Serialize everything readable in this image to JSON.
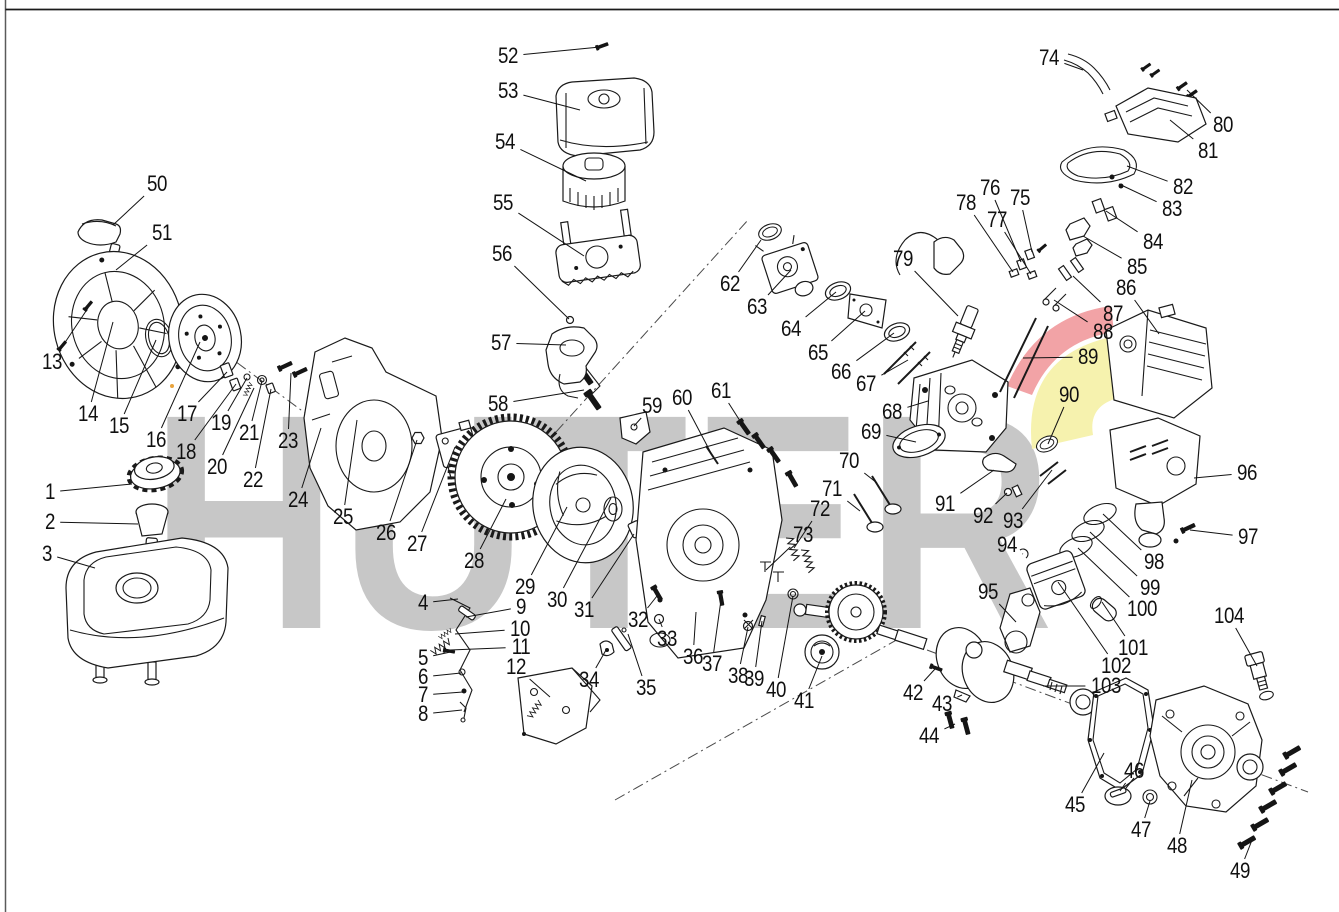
{
  "brand": {
    "watermark_text": "HUTER",
    "watermark_color": "#c7c7c7",
    "swoosh_red": "#f2a3a6",
    "swoosh_yellow": "#f6f2ae",
    "line_color": "#1a1a1a"
  },
  "callouts": [
    {
      "n": "1",
      "x": 50,
      "y": 492,
      "tx": 132,
      "ty": 484
    },
    {
      "n": "2",
      "x": 50,
      "y": 522,
      "tx": 138,
      "ty": 524
    },
    {
      "n": "3",
      "x": 47,
      "y": 554,
      "tx": 95,
      "ty": 568
    },
    {
      "n": "4",
      "x": 423,
      "y": 603,
      "tx": 458,
      "ty": 599
    },
    {
      "n": "5",
      "x": 423,
      "y": 658,
      "tx": 455,
      "ty": 651
    },
    {
      "n": "6",
      "x": 423,
      "y": 677,
      "tx": 461,
      "ty": 673
    },
    {
      "n": "7",
      "x": 423,
      "y": 695,
      "tx": 463,
      "ty": 692
    },
    {
      "n": "8",
      "x": 423,
      "y": 714,
      "tx": 462,
      "ty": 710
    },
    {
      "n": "9",
      "x": 521,
      "y": 607,
      "tx": 466,
      "ty": 617
    },
    {
      "n": "10",
      "x": 520,
      "y": 629,
      "tx": 455,
      "ty": 634
    },
    {
      "n": "11",
      "x": 521,
      "y": 647,
      "tx": 450,
      "ty": 650
    },
    {
      "n": "12",
      "x": 516,
      "y": 667,
      "tx": 550,
      "ty": 697
    },
    {
      "n": "13",
      "x": 52,
      "y": 362,
      "tx": 88,
      "ty": 308
    },
    {
      "n": "14",
      "x": 88,
      "y": 414,
      "tx": 113,
      "ty": 322
    },
    {
      "n": "15",
      "x": 119,
      "y": 426,
      "tx": 156,
      "ty": 340
    },
    {
      "n": "16",
      "x": 156,
      "y": 440,
      "tx": 200,
      "ty": 342
    },
    {
      "n": "17",
      "x": 187,
      "y": 414,
      "tx": 227,
      "ty": 372
    },
    {
      "n": "18",
      "x": 186,
      "y": 452,
      "tx": 236,
      "ty": 384
    },
    {
      "n": "19",
      "x": 221,
      "y": 423,
      "tx": 247,
      "ty": 378
    },
    {
      "n": "20",
      "x": 217,
      "y": 467,
      "tx": 254,
      "ty": 388
    },
    {
      "n": "21",
      "x": 249,
      "y": 433,
      "tx": 262,
      "ty": 381
    },
    {
      "n": "22",
      "x": 253,
      "y": 480,
      "tx": 271,
      "ty": 389
    },
    {
      "n": "23",
      "x": 288,
      "y": 441,
      "tx": 291,
      "ty": 373
    },
    {
      "n": "24",
      "x": 298,
      "y": 500,
      "tx": 321,
      "ty": 428
    },
    {
      "n": "25",
      "x": 343,
      "y": 517,
      "tx": 357,
      "ty": 420
    },
    {
      "n": "26",
      "x": 386,
      "y": 533,
      "tx": 417,
      "ty": 440
    },
    {
      "n": "27",
      "x": 417,
      "y": 544,
      "tx": 455,
      "ty": 447
    },
    {
      "n": "28",
      "x": 474,
      "y": 561,
      "tx": 506,
      "ty": 499
    },
    {
      "n": "29",
      "x": 525,
      "y": 587,
      "tx": 567,
      "ty": 507
    },
    {
      "n": "30",
      "x": 557,
      "y": 600,
      "tx": 611,
      "ty": 498
    },
    {
      "n": "31",
      "x": 584,
      "y": 610,
      "tx": 634,
      "ty": 534
    },
    {
      "n": "32",
      "x": 638,
      "y": 620,
      "tx": 657,
      "ty": 596
    },
    {
      "n": "33",
      "x": 667,
      "y": 639,
      "tx": 659,
      "ty": 619
    },
    {
      "n": "34",
      "x": 589,
      "y": 680,
      "tx": 606,
      "ty": 650
    },
    {
      "n": "35",
      "x": 646,
      "y": 688,
      "tx": 628,
      "ty": 634
    },
    {
      "n": "36",
      "x": 693,
      "y": 657,
      "tx": 696,
      "ty": 612
    },
    {
      "n": "37",
      "x": 712,
      "y": 664,
      "tx": 721,
      "ty": 600
    },
    {
      "n": "38",
      "x": 738,
      "y": 676,
      "tx": 748,
      "ty": 627
    },
    {
      "n": "39",
      "x": 754,
      "y": 679,
      "tx": 762,
      "ty": 621
    },
    {
      "n": "40",
      "x": 776,
      "y": 690,
      "tx": 793,
      "ty": 596
    },
    {
      "n": "41",
      "x": 804,
      "y": 701,
      "tx": 822,
      "ty": 656
    },
    {
      "n": "42",
      "x": 913,
      "y": 693,
      "tx": 935,
      "ty": 669
    },
    {
      "n": "43",
      "x": 942,
      "y": 704,
      "tx": 962,
      "ty": 695
    },
    {
      "n": "44",
      "x": 929,
      "y": 736,
      "tx": 955,
      "ty": 724
    },
    {
      "n": "45",
      "x": 1075,
      "y": 805,
      "tx": 1104,
      "ty": 753
    },
    {
      "n": "46",
      "x": 1134,
      "y": 771,
      "tx": 1120,
      "ty": 791
    },
    {
      "n": "47",
      "x": 1141,
      "y": 830,
      "tx": 1150,
      "ty": 801
    },
    {
      "n": "48",
      "x": 1177,
      "y": 846,
      "tx": 1192,
      "ty": 780
    },
    {
      "n": "49",
      "x": 1240,
      "y": 871,
      "tx": 1252,
      "ty": 840
    },
    {
      "n": "50",
      "x": 157,
      "y": 184,
      "tx": 113,
      "ty": 225
    },
    {
      "n": "51",
      "x": 162,
      "y": 233,
      "tx": 116,
      "ty": 270
    },
    {
      "n": "52",
      "x": 508,
      "y": 56,
      "tx": 600,
      "ty": 47
    },
    {
      "n": "53",
      "x": 508,
      "y": 91,
      "tx": 580,
      "ty": 110
    },
    {
      "n": "54",
      "x": 505,
      "y": 142,
      "tx": 586,
      "ty": 181
    },
    {
      "n": "55",
      "x": 503,
      "y": 203,
      "tx": 584,
      "ty": 256
    },
    {
      "n": "56",
      "x": 502,
      "y": 254,
      "tx": 569,
      "ty": 319
    },
    {
      "n": "57",
      "x": 501,
      "y": 343,
      "tx": 566,
      "ty": 345
    },
    {
      "n": "58",
      "x": 498,
      "y": 404,
      "tx": 584,
      "ty": 390
    },
    {
      "n": "59",
      "x": 652,
      "y": 406,
      "tx": 634,
      "ty": 426
    },
    {
      "n": "60",
      "x": 682,
      "y": 398,
      "tx": 711,
      "ty": 453
    },
    {
      "n": "61",
      "x": 721,
      "y": 391,
      "tx": 742,
      "ty": 424
    },
    {
      "n": "62",
      "x": 730,
      "y": 284,
      "tx": 761,
      "ty": 240
    },
    {
      "n": "63",
      "x": 757,
      "y": 307,
      "tx": 791,
      "ty": 270
    },
    {
      "n": "64",
      "x": 791,
      "y": 329,
      "tx": 836,
      "ty": 292
    },
    {
      "n": "65",
      "x": 818,
      "y": 353,
      "tx": 865,
      "ty": 311
    },
    {
      "n": "66",
      "x": 841,
      "y": 372,
      "tx": 894,
      "ty": 333
    },
    {
      "n": "67",
      "x": 866,
      "y": 384,
      "tx": 908,
      "ty": 360
    },
    {
      "n": "68",
      "x": 892,
      "y": 412,
      "tx": 928,
      "ty": 401
    },
    {
      "n": "69",
      "x": 871,
      "y": 432,
      "tx": 916,
      "ty": 442
    },
    {
      "n": "70",
      "x": 849,
      "y": 461,
      "tx": 877,
      "ty": 483
    },
    {
      "n": "71",
      "x": 832,
      "y": 489,
      "tx": 860,
      "ty": 511
    },
    {
      "n": "72",
      "x": 820,
      "y": 509,
      "tx": 794,
      "ty": 548
    },
    {
      "n": "73",
      "x": 803,
      "y": 535,
      "tx": 766,
      "ty": 570
    },
    {
      "n": "74",
      "x": 1049,
      "y": 58,
      "tx": 1083,
      "ty": 70
    },
    {
      "n": "75",
      "x": 1020,
      "y": 198,
      "tx": 1032,
      "ty": 252
    },
    {
      "n": "76",
      "x": 990,
      "y": 188,
      "tx": 1021,
      "ty": 262
    },
    {
      "n": "77",
      "x": 997,
      "y": 220,
      "tx": 1031,
      "ty": 274
    },
    {
      "n": "78",
      "x": 966,
      "y": 203,
      "tx": 1013,
      "ty": 272
    },
    {
      "n": "79",
      "x": 903,
      "y": 259,
      "tx": 958,
      "ty": 316
    },
    {
      "n": "80",
      "x": 1223,
      "y": 125,
      "tx": 1187,
      "ty": 90
    },
    {
      "n": "81",
      "x": 1208,
      "y": 151,
      "tx": 1170,
      "ty": 120
    },
    {
      "n": "82",
      "x": 1183,
      "y": 187,
      "tx": 1127,
      "ty": 166
    },
    {
      "n": "83",
      "x": 1172,
      "y": 209,
      "tx": 1119,
      "ty": 184
    },
    {
      "n": "84",
      "x": 1153,
      "y": 242,
      "tx": 1106,
      "ty": 211
    },
    {
      "n": "85",
      "x": 1137,
      "y": 267,
      "tx": 1083,
      "ty": 236
    },
    {
      "n": "86",
      "x": 1126,
      "y": 288,
      "tx": 1159,
      "ty": 334
    },
    {
      "n": "87",
      "x": 1113,
      "y": 314,
      "tx": 1073,
      "ty": 276
    },
    {
      "n": "88",
      "x": 1103,
      "y": 332,
      "tx": 1054,
      "ty": 300
    },
    {
      "n": "89",
      "x": 1088,
      "y": 357,
      "tx": 1023,
      "ty": 358
    },
    {
      "n": "90",
      "x": 1069,
      "y": 395,
      "tx": 1048,
      "ty": 444
    },
    {
      "n": "91",
      "x": 945,
      "y": 504,
      "tx": 994,
      "ty": 470
    },
    {
      "n": "92",
      "x": 983,
      "y": 516,
      "tx": 1007,
      "ty": 493
    },
    {
      "n": "93",
      "x": 1013,
      "y": 521,
      "tx": 1052,
      "ty": 470
    },
    {
      "n": "94",
      "x": 1007,
      "y": 545,
      "tx": 1023,
      "ty": 554
    },
    {
      "n": "95",
      "x": 988,
      "y": 592,
      "tx": 1016,
      "ty": 622
    },
    {
      "n": "96",
      "x": 1247,
      "y": 473,
      "tx": 1194,
      "ty": 478
    },
    {
      "n": "97",
      "x": 1248,
      "y": 537,
      "tx": 1190,
      "ty": 530
    },
    {
      "n": "98",
      "x": 1154,
      "y": 562,
      "tx": 1103,
      "ty": 514
    },
    {
      "n": "99",
      "x": 1150,
      "y": 588,
      "tx": 1090,
      "ty": 532
    },
    {
      "n": "100",
      "x": 1142,
      "y": 609,
      "tx": 1078,
      "ty": 548
    },
    {
      "n": "101",
      "x": 1133,
      "y": 648,
      "tx": 1102,
      "ty": 602
    },
    {
      "n": "102",
      "x": 1116,
      "y": 666,
      "tx": 1058,
      "ty": 582
    },
    {
      "n": "103",
      "x": 1106,
      "y": 686,
      "tx": 1043,
      "ty": 686
    },
    {
      "n": "104",
      "x": 1229,
      "y": 616,
      "tx": 1257,
      "ty": 666
    }
  ]
}
